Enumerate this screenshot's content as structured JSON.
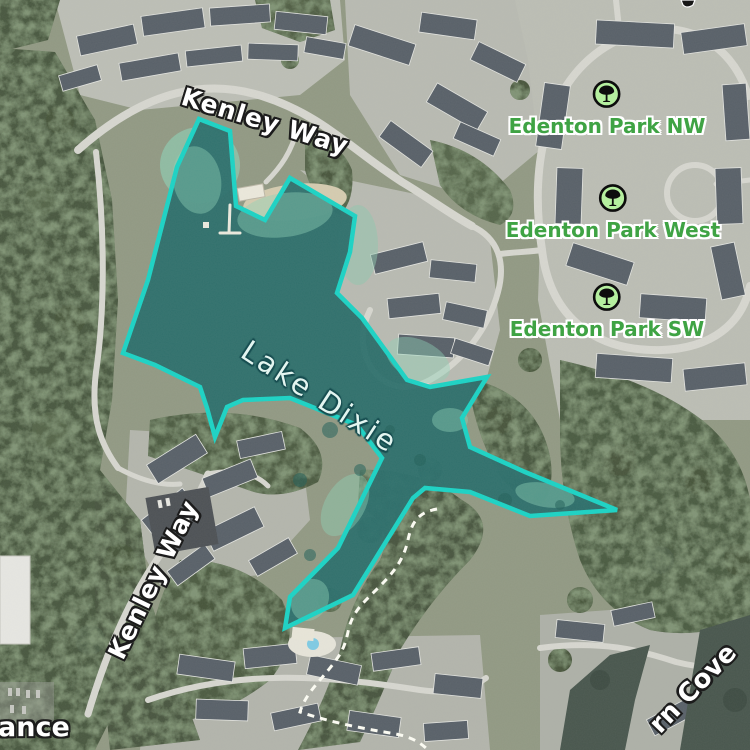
{
  "map": {
    "view": "satellite",
    "lake": {
      "label": "Lake Dixie",
      "outline_color": "#1bd3c5",
      "fill_color": "#2d6f6c"
    },
    "road_labels": [
      {
        "id": "kenley-way-top",
        "text": "Kenley Way"
      },
      {
        "id": "kenley-way-west",
        "text": "Kenley Way"
      }
    ],
    "park_labels": [
      {
        "id": "edenton-park-nw",
        "text": "Edenton Park NW",
        "icon": "tree-icon"
      },
      {
        "id": "edenton-park-west",
        "text": "Edenton Park West",
        "icon": "tree-icon"
      },
      {
        "id": "edenton-park-sw",
        "text": "Edenton Park SW",
        "icon": "tree-icon"
      }
    ],
    "partial_labels": [
      {
        "id": "entrance-partial",
        "text": "ance"
      },
      {
        "id": "cove-partial",
        "text": "rn Cove"
      }
    ],
    "colors": {
      "park_label_green": "#3fa344",
      "park_icon_bg": "#b5ef9f",
      "road_label_white": "#ffffff",
      "trail_dash_white": "#fdfdf4"
    }
  }
}
